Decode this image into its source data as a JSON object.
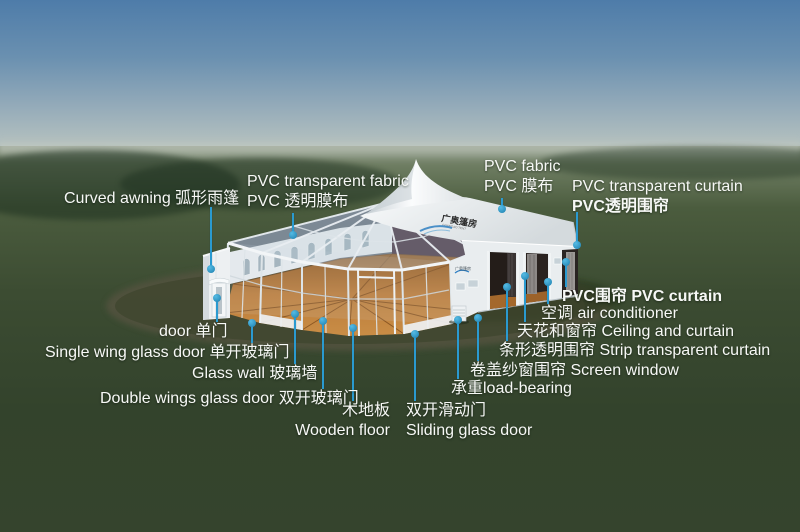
{
  "colors": {
    "leader_line": "#2a9ad0",
    "label_text": "#f7f8f6",
    "sky_top": "#4e7ca9",
    "grass": "#33432c",
    "wood_floor": "#b5773a",
    "tent_white": "#f3f5f6"
  },
  "logo": {
    "roof_name": "广奥篷房",
    "roof_subtitle": "GUANGAO TENT",
    "wall_name": "广奥篷房"
  },
  "labels": [
    {
      "id": "curved-awning",
      "lines": [
        "Curved awning 弧形雨篷"
      ]
    },
    {
      "id": "pvc-transparent-fabric",
      "lines": [
        "PVC transparent fabric",
        "PVC 透明膜布"
      ]
    },
    {
      "id": "pvc-fabric",
      "lines": [
        "PVC fabric",
        "PVC 膜布"
      ]
    },
    {
      "id": "pvc-transparent-curtain",
      "lines": [
        "PVC transparent curtain",
        "PVC透明围帘"
      ]
    },
    {
      "id": "door",
      "lines": [
        "door 单门"
      ]
    },
    {
      "id": "single-wing-glass-door",
      "lines": [
        "Single wing glass door 单开玻璃门"
      ]
    },
    {
      "id": "glass-wall",
      "lines": [
        "Glass wall 玻璃墙"
      ]
    },
    {
      "id": "double-wings-glass-door",
      "lines": [
        "Double wings glass door 双开玻璃门"
      ]
    },
    {
      "id": "wooden-floor",
      "lines": [
        "木地板",
        "Wooden floor"
      ]
    },
    {
      "id": "sliding-glass-door",
      "lines": [
        "双开滑动门",
        "Sliding glass door"
      ]
    },
    {
      "id": "load-bearing",
      "lines": [
        "承重load-bearing"
      ]
    },
    {
      "id": "screen-window",
      "lines": [
        "卷盖纱窗围帘 Screen window"
      ]
    },
    {
      "id": "strip-transparent-curtain",
      "lines": [
        "条形透明围帘 Strip transparent curtain"
      ]
    },
    {
      "id": "ceiling-and-curtain",
      "lines": [
        "天花和窗帘 Ceiling and curtain"
      ]
    },
    {
      "id": "air-conditioner",
      "lines": [
        "空调 air conditioner"
      ]
    },
    {
      "id": "pvc-curtain",
      "lines": [
        "PVC围帘 PVC curtain"
      ]
    }
  ]
}
